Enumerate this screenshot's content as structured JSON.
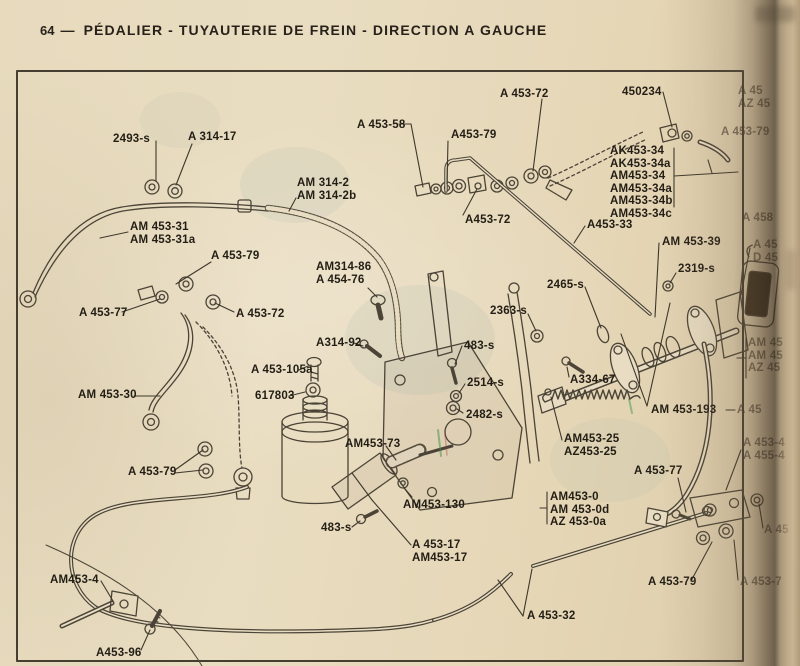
{
  "header": {
    "page_number": "64",
    "separator": "—",
    "title": "PÉDALIER - TUYAUTERIE DE FREIN - DIRECTION A GAUCHE"
  },
  "colors": {
    "paper": "#e8dcc0",
    "ink": "#27211a",
    "line_ink": "#3e382c",
    "sketch_stroke": "#4b4437",
    "pad_fill": "#3a2f20"
  },
  "diagram": {
    "labels": [
      {
        "lines": [
          "2493-s"
        ],
        "x": 113,
        "y": 132,
        "leaders": [
          [
            156,
            141,
            156,
            181
          ]
        ]
      },
      {
        "lines": [
          "A 314-17"
        ],
        "x": 188,
        "y": 130,
        "leaders": [
          [
            192,
            144,
            176,
            185
          ]
        ]
      },
      {
        "lines": [
          "AM 453-31",
          "AM 453-31a"
        ],
        "x": 130,
        "y": 220,
        "leaders": [
          [
            128,
            232,
            100,
            238
          ]
        ]
      },
      {
        "lines": [
          "A 453-79"
        ],
        "x": 211,
        "y": 249,
        "leaders": [
          [
            211,
            262,
            176,
            284
          ]
        ]
      },
      {
        "lines": [
          "A 453-77"
        ],
        "x": 79,
        "y": 306,
        "leaders": [
          [
            122,
            312,
            160,
            299
          ]
        ]
      },
      {
        "lines": [
          "A 453-72"
        ],
        "x": 236,
        "y": 307,
        "leaders": [
          [
            234,
            312,
            215,
            303
          ]
        ]
      },
      {
        "lines": [
          "AM 453-30"
        ],
        "x": 78,
        "y": 388,
        "leaders": [
          [
            134,
            396,
            160,
            396
          ]
        ]
      },
      {
        "lines": [
          "A 453-79"
        ],
        "x": 128,
        "y": 465,
        "leaders": [
          [
            175,
            470,
            203,
            450
          ],
          [
            175,
            473,
            203,
            470
          ]
        ]
      },
      {
        "lines": [
          "AM453-4"
        ],
        "x": 50,
        "y": 573,
        "leaders": [
          [
            101,
            581,
            113,
            601
          ]
        ]
      },
      {
        "lines": [
          "A453-96"
        ],
        "x": 96,
        "y": 646,
        "leaders": [
          [
            141,
            650,
            150,
            630
          ]
        ]
      },
      {
        "lines": [
          "AM 314-2",
          "AM 314-2b"
        ],
        "x": 297,
        "y": 176,
        "leaders": [
          [
            296,
            198,
            289,
            211
          ]
        ]
      },
      {
        "lines": [
          "AM314-86",
          "A 454-76"
        ],
        "x": 316,
        "y": 260,
        "leaders": [
          [
            368,
            288,
            377,
            297
          ]
        ]
      },
      {
        "lines": [
          "A314-92"
        ],
        "x": 316,
        "y": 336,
        "leaders": [
          [
            354,
            343,
            363,
            346
          ]
        ]
      },
      {
        "lines": [
          "A 453-105a"
        ],
        "x": 251,
        "y": 363,
        "leaders": [
          [
            299,
            370,
            308,
            366
          ]
        ]
      },
      {
        "lines": [
          "617803"
        ],
        "x": 255,
        "y": 389,
        "leaders": [
          [
            289,
            396,
            305,
            392
          ]
        ]
      },
      {
        "lines": [
          "AM453-73"
        ],
        "x": 345,
        "y": 437,
        "leaders": [
          [
            386,
            446,
            396,
            460
          ]
        ]
      },
      {
        "lines": [
          "AM453-130"
        ],
        "x": 403,
        "y": 498,
        "leaders": [
          [
            412,
            497,
            404,
            488
          ]
        ]
      },
      {
        "lines": [
          "483-s"
        ],
        "x": 321,
        "y": 521,
        "leaders": [
          [
            352,
            527,
            360,
            521
          ]
        ]
      },
      {
        "lines": [
          "A 453-17",
          "AM453-17"
        ],
        "x": 412,
        "y": 538,
        "leaders": [
          [
            411,
            545,
            372,
            500
          ],
          [
            372,
            500,
            352,
            473
          ]
        ]
      },
      {
        "lines": [
          "A 453-32"
        ],
        "x": 527,
        "y": 609,
        "leaders": [
          [
            523,
            616,
            498,
            580
          ],
          [
            523,
            616,
            532,
            569
          ]
        ]
      },
      {
        "lines": [
          "A 453-58"
        ],
        "x": 357,
        "y": 118,
        "leaders": [
          [
            399,
            124,
            411,
            124
          ],
          [
            411,
            124,
            423,
            187
          ]
        ]
      },
      {
        "lines": [
          "A453-79"
        ],
        "x": 451,
        "y": 128,
        "leaders": [
          [
            448,
            141,
            447,
            184
          ]
        ]
      },
      {
        "lines": [
          "A 453-72"
        ],
        "x": 500,
        "y": 87,
        "leaders": [
          [
            542,
            99,
            533,
            171
          ]
        ]
      },
      {
        "lines": [
          "A453-72"
        ],
        "x": 465,
        "y": 213,
        "leaders": [
          [
            463,
            215,
            477,
            189
          ]
        ]
      },
      {
        "lines": [
          "450234"
        ],
        "x": 622,
        "y": 85,
        "leaders": [
          [
            663,
            92,
            672,
            127
          ]
        ]
      },
      {
        "lines": [
          "AK453-34",
          "AK453-34a",
          "AM453-34",
          "AM453-34a",
          "AM453-34b",
          "AM453-34c"
        ],
        "x": 610,
        "y": 144,
        "leaders": [
          [
            674,
            148,
            674,
            207
          ],
          [
            674,
            176,
            738,
            172
          ],
          [
            712,
            173,
            708,
            160
          ]
        ]
      },
      {
        "lines": [
          "A453-33"
        ],
        "x": 587,
        "y": 218,
        "leaders": [
          [
            585,
            226,
            574,
            243
          ]
        ]
      },
      {
        "lines": [
          "AM 453-39"
        ],
        "x": 662,
        "y": 235,
        "leaders": [
          [
            659,
            243,
            655,
            317
          ]
        ]
      },
      {
        "lines": [
          "2319-s"
        ],
        "x": 678,
        "y": 262,
        "leaders": [
          [
            676,
            273,
            670,
            283
          ]
        ]
      },
      {
        "lines": [
          "2465-s"
        ],
        "x": 547,
        "y": 278,
        "leaders": [
          [
            585,
            287,
            601,
            328
          ]
        ]
      },
      {
        "lines": [
          "2363-s"
        ],
        "x": 490,
        "y": 304,
        "leaders": [
          [
            528,
            314,
            536,
            331
          ]
        ]
      },
      {
        "lines": [
          "483-s"
        ],
        "x": 464,
        "y": 339,
        "leaders": [
          [
            462,
            346,
            455,
            364
          ]
        ]
      },
      {
        "lines": [
          "2514-s"
        ],
        "x": 467,
        "y": 376,
        "leaders": [
          [
            465,
            384,
            459,
            393
          ]
        ]
      },
      {
        "lines": [
          "2482-s"
        ],
        "x": 466,
        "y": 408,
        "leaders": [
          [
            463,
            413,
            457,
            409
          ]
        ]
      },
      {
        "lines": [
          "A334-67"
        ],
        "x": 570,
        "y": 373,
        "leaders": [
          [
            569,
            377,
            567,
            367
          ]
        ]
      },
      {
        "lines": [
          "AM 453-193"
        ],
        "x": 651,
        "y": 403,
        "leaders": [
          [
            647,
            406,
            621,
            334
          ],
          [
            647,
            406,
            670,
            303
          ]
        ]
      },
      {
        "lines": [
          "AM453-25",
          "AZ453-25"
        ],
        "x": 564,
        "y": 432,
        "leaders": [
          [
            562,
            440,
            551,
            397
          ]
        ]
      },
      {
        "lines": [
          "A 453-77"
        ],
        "x": 634,
        "y": 464,
        "leaders": [
          [
            678,
            478,
            686,
            512
          ]
        ]
      },
      {
        "lines": [
          "AM453-0",
          "AM 453-0d",
          "AZ 453-0a"
        ],
        "x": 550,
        "y": 490,
        "leaders": [
          [
            547,
            492,
            547,
            524
          ],
          [
            547,
            508,
            540,
            508
          ]
        ]
      },
      {
        "lines": [
          "A 453-79"
        ],
        "x": 648,
        "y": 575,
        "leaders": [
          [
            691,
            581,
            712,
            542
          ]
        ]
      },
      {
        "lines": [
          "A 45",
          "AZ 45"
        ],
        "x": 738,
        "y": 84,
        "partial": true
      },
      {
        "lines": [
          "A 453-79"
        ],
        "x": 721,
        "y": 125,
        "partial": true
      },
      {
        "lines": [
          "A 458"
        ],
        "x": 742,
        "y": 211,
        "partial": true
      },
      {
        "lines": [
          "A 45",
          "D 45"
        ],
        "x": 753,
        "y": 238,
        "partial": true,
        "leaders": [
          [
            750,
            248,
            741,
            295
          ]
        ]
      },
      {
        "lines": [
          "AM 45",
          "AM 45",
          "AZ 45"
        ],
        "x": 748,
        "y": 336,
        "partial": true,
        "leaders": [
          [
            746,
            338,
            746,
            378
          ],
          [
            746,
            358,
            737,
            358
          ]
        ]
      },
      {
        "lines": [
          "A 45"
        ],
        "x": 737,
        "y": 403,
        "partial": true,
        "leaders": [
          [
            735,
            410,
            726,
            410
          ]
        ]
      },
      {
        "lines": [
          "A 453-4",
          "A 455-4"
        ],
        "x": 743,
        "y": 436,
        "partial": true,
        "leaders": [
          [
            741,
            450,
            726,
            490
          ]
        ]
      },
      {
        "lines": [
          "A 45"
        ],
        "x": 764,
        "y": 523,
        "partial": true,
        "leaders": [
          [
            763,
            528,
            759,
            504
          ]
        ]
      },
      {
        "lines": [
          "A 453-7"
        ],
        "x": 740,
        "y": 575,
        "partial": true,
        "leaders": [
          [
            738,
            580,
            734,
            540
          ]
        ]
      }
    ]
  }
}
